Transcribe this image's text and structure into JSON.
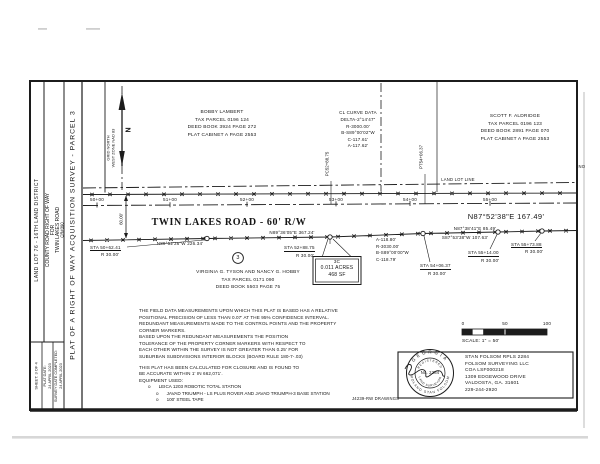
{
  "colors": {
    "ink": "#1c1c1c",
    "text": "#151515",
    "shadow": "#c9c9c9"
  },
  "titleblock": {
    "plat_title": "PLAT OF A RIGHT OF WAY ACQUISITION SURVEY - PARCEL 3",
    "county_lines": [
      "COUNTY ROAD RIGHT OF WAY",
      "FOR",
      "TWIN LAKES ROAD",
      "CR#390"
    ],
    "land_lot": "LAND LOT 76 - 16TH LAND DISTRICT",
    "survey_date_label": "SURVEY DATE COMPLETED:",
    "survey_date": "24 APRIL 2023",
    "plat_date_label": "PLAT DATE:",
    "plat_date": "24 APRIL 2023",
    "sheet": "SHEET: 3 OF 4"
  },
  "north_arrow": {
    "letter": "N",
    "label1": "GRID NORTH",
    "label2": "WEST ZONE NAD 83"
  },
  "owners": {
    "north": {
      "name": "BOBBY LAMBERT",
      "tax": "TAX PARCEL 0196 124",
      "deed": "DEED BOOK 3924 PAGE 272",
      "plat": "PLAT CABINET A PAGE 2553"
    },
    "east": {
      "name": "SCOTT F. ALDRIDGE",
      "tax": "TAX PARCEL 0196 123",
      "deed": "DEED BOOK 2891 PAGE 070",
      "plat": "PLAT CABINET A PAGE 2553"
    },
    "south": {
      "badge": "3",
      "name": "VIRGINIA G. TYSON AND NANCY G. HOBBY",
      "tax": "TAX PARCEL 0171 090",
      "deed": "DEED BOOK 5503 PAGE 75"
    }
  },
  "curve_table": {
    "title": "CL CURVE DATA",
    "rows": [
      "DELTA-2°14'47\"",
      "R-3000.00'",
      "B-S89°00'02\"W",
      "C-117.61'",
      "A-117.62'"
    ]
  },
  "rw_curve": {
    "rows": [
      "A-118.80'",
      "R-3030.00'",
      "B-S89°00'00\"W",
      "C-118.79'"
    ]
  },
  "road": {
    "name": "TWIN LAKES ROAD - 60' R/W",
    "land_lot_line": "LAND LOT LINE",
    "corner_note": "NO",
    "stations": [
      "50+00",
      "51+00",
      "52+00",
      "53+00",
      "54+00",
      "55+00"
    ],
    "pc": "PC52+88.75",
    "pt": "PT54+06.37",
    "width_dim": "60.00'",
    "bearing_main": "N87°52'38\"E   167.49'",
    "bearing_w": "N89°52'26\"W   226.34'",
    "bearing_acq": "N89°36'05\"E   367.24'",
    "bearing_e1": "N87°38'41\"E   85.49'",
    "bearing_e2": "S87°53'38\"W   107.63'",
    "sta": [
      {
        "s": "STA 50+62.41",
        "r": "R 30.00'"
      },
      {
        "s": "STA 52+88.75",
        "r": "R 30.00'"
      },
      {
        "s": "STA 54+06.37",
        "r": "R 30.00'"
      },
      {
        "s": "STA 55+14.00",
        "r": "R 30.00'"
      },
      {
        "s": "STA 55+73.88",
        "r": "R 30.00'"
      }
    ],
    "area": {
      "id": "3C",
      "acres": "0.011 ACRES",
      "sf": "468 SF"
    }
  },
  "notes": {
    "lines": [
      "THE FIELD DATA MEASUREMENTS UPON WHICH THIS PLAT IS BASED HAS A RELATIVE",
      "POSITIONAL PRECISION OF LESS THAN 0.07' AT THE 95% CONFIDENCE INTERVAL.",
      "REDUNDANT MEASUREMENTS MADE TO THE CONTROL POINTS AND THE PROPERTY",
      "CORNER MARKERS.",
      "BASED UPON THE REDUNDANT MEASUREMENTS THE POSITION",
      "TOLERANCE OF THE PROPERTY CORNER MARKERS WITH RESPECT TO",
      "EACH OTHER WITHIN THE SURVEY IS NOT GREATER THAN 0.25' FOR",
      "SUBURBAN SUBDIVISIONS INTERIOR BLOCKS (BOARD RULE 180-7-.03)",
      "THIS PLAT HAS BEEN CALCULATED FOR CLOSURE AND IS FOUND TO",
      "BE ACCURATE WITHIN 1' IN 662,071'.",
      "EQUIPMENT USED:"
    ],
    "bullet": "o",
    "equipment": [
      "LEICA 1203 ROBOTIC TOTAL STATION",
      "JAVAD TRIUMPH - LS PLUS ROVER AND JAVAD TRIUMPH-3  BASE STATION",
      "100' STEEL TAPE"
    ],
    "drawing_ref": "J4239-RW DRAWINGS"
  },
  "scale": {
    "t0": "0",
    "t50": "50",
    "t100": "100",
    "label": "SCALE: 1\" = 50'"
  },
  "surveyor": {
    "seal_top": "GEORGIA",
    "seal_reg": "REGISTERED",
    "seal_no": "No. 2284",
    "seal_bottom": "LAND SURVEYOR",
    "seal_outer_bottom": "ROLAND  STAN  FOLSOM",
    "lines": [
      "STAN FOLSOM RPLS 2284",
      "FOLSOM SURVEYING LLC",
      "COA LSF000218",
      "1309 EDGEWOOD DRIVE",
      "VALDOSTA, GA. 31601",
      "229-244-2920"
    ]
  }
}
